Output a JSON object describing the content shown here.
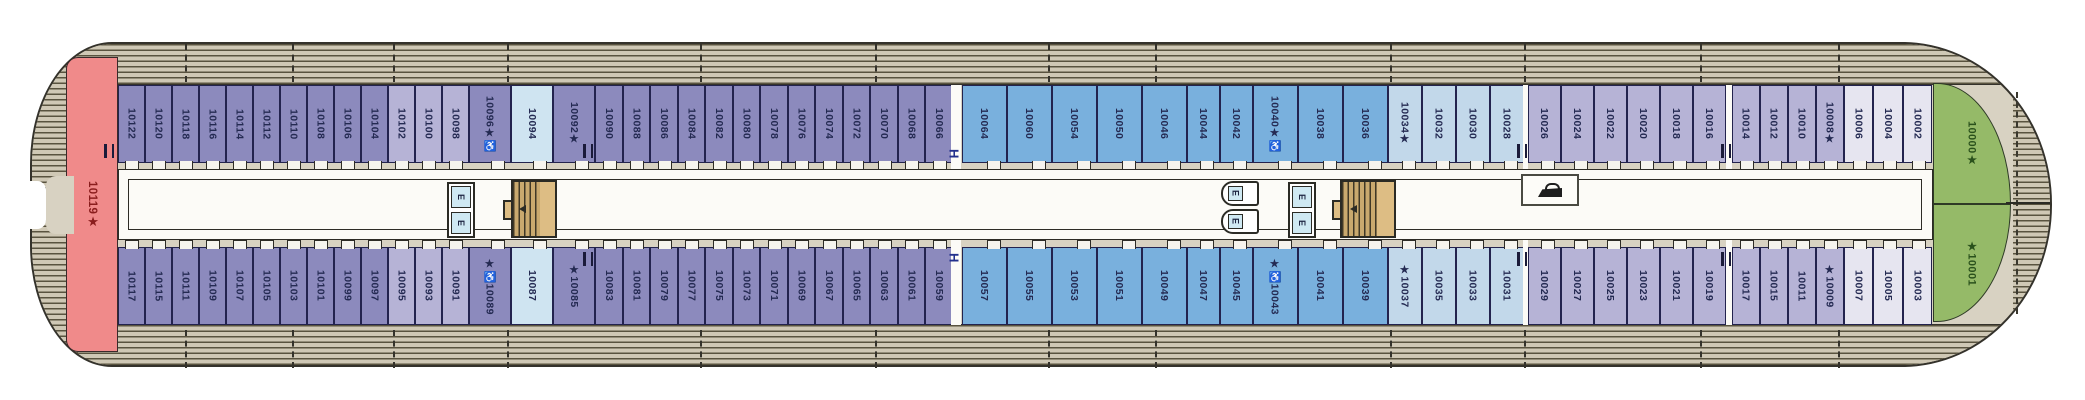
{
  "deck": {
    "layout": {
      "row_start_x": 118
    },
    "labels": {
      "elevator": "E",
      "crossing": "H"
    },
    "symbols": {
      "accessible_suite": "★♿",
      "suite": "★"
    },
    "colors": {
      "purple": "#8c8abd",
      "lavender": "#b6b3d6",
      "paleblue": "#cfe4f1",
      "blue": "#79b0dd",
      "bluelight": "#c2d8ea",
      "whitelav": "#e6e5f0",
      "red": "#f08a8a",
      "green": "#95ba68",
      "hull": "#d8d2c2",
      "corridor": "#fcfbf7"
    },
    "specials": {
      "stern": {
        "n": "10119",
        "sym": "★",
        "side": "suffix"
      },
      "bow_top": {
        "n": "10000",
        "sym": "★",
        "side": "suffix"
      },
      "bow_bottom": {
        "n": "10001",
        "sym": "★",
        "side": "prefix"
      }
    },
    "rows": {
      "top": [
        {
          "n": "10122",
          "c": "purple",
          "w": 27
        },
        {
          "n": "10120",
          "c": "purple",
          "w": 27
        },
        {
          "n": "10118",
          "c": "purple",
          "w": 27
        },
        {
          "n": "10116",
          "c": "purple",
          "w": 27
        },
        {
          "n": "10114",
          "c": "purple",
          "w": 27
        },
        {
          "n": "10112",
          "c": "purple",
          "w": 27
        },
        {
          "n": "10110",
          "c": "purple",
          "w": 27
        },
        {
          "n": "10108",
          "c": "purple",
          "w": 27
        },
        {
          "n": "10106",
          "c": "purple",
          "w": 27
        },
        {
          "n": "10104",
          "c": "purple",
          "w": 27
        },
        {
          "n": "10102",
          "c": "lavender",
          "w": 27
        },
        {
          "n": "10100",
          "c": "lavender",
          "w": 27
        },
        {
          "n": "10098",
          "c": "lavender",
          "w": 27
        },
        {
          "n": "10096",
          "c": "purple",
          "w": 42,
          "sym": "★♿"
        },
        {
          "n": "10094",
          "c": "paleblue",
          "w": 42
        },
        {
          "n": "10092",
          "c": "purple",
          "w": 42,
          "sym": "★"
        },
        {
          "n": "10090",
          "c": "purple",
          "w": 27.5
        },
        {
          "n": "10088",
          "c": "purple",
          "w": 27.5
        },
        {
          "n": "10086",
          "c": "purple",
          "w": 27.5
        },
        {
          "n": "10084",
          "c": "purple",
          "w": 27.5
        },
        {
          "n": "10082",
          "c": "purple",
          "w": 27.5
        },
        {
          "n": "10080",
          "c": "purple",
          "w": 27.5
        },
        {
          "n": "10078",
          "c": "purple",
          "w": 27.5
        },
        {
          "n": "10076",
          "c": "purple",
          "w": 27.5
        },
        {
          "n": "10074",
          "c": "purple",
          "w": 27.5
        },
        {
          "n": "10072",
          "c": "purple",
          "w": 27.5
        },
        {
          "n": "10070",
          "c": "purple",
          "w": 27.5
        },
        {
          "n": "10068",
          "c": "purple",
          "w": 27.5
        },
        {
          "n": "10066",
          "c": "purple",
          "w": 27.5
        },
        {
          "n": "10064",
          "c": "blue",
          "w": 45,
          "g": 9
        },
        {
          "n": "10060",
          "c": "blue",
          "w": 45
        },
        {
          "n": "10054",
          "c": "blue",
          "w": 45
        },
        {
          "n": "10050",
          "c": "blue",
          "w": 45
        },
        {
          "n": "10046",
          "c": "blue",
          "w": 45
        },
        {
          "n": "10044",
          "c": "blue",
          "w": 33
        },
        {
          "n": "10042",
          "c": "blue",
          "w": 33
        },
        {
          "n": "10040",
          "c": "blue",
          "w": 45,
          "sym": "★♿"
        },
        {
          "n": "10038",
          "c": "blue",
          "w": 45
        },
        {
          "n": "10036",
          "c": "blue",
          "w": 45
        },
        {
          "n": "10034",
          "c": "bluelight",
          "w": 34,
          "sym": "★"
        },
        {
          "n": "10032",
          "c": "bluelight",
          "w": 34
        },
        {
          "n": "10030",
          "c": "bluelight",
          "w": 34
        },
        {
          "n": "10028",
          "c": "bluelight",
          "w": 34
        },
        {
          "n": "10026",
          "c": "lavender",
          "w": 33,
          "g": 4
        },
        {
          "n": "10024",
          "c": "lavender",
          "w": 33
        },
        {
          "n": "10022",
          "c": "lavender",
          "w": 33
        },
        {
          "n": "10020",
          "c": "lavender",
          "w": 33
        },
        {
          "n": "10018",
          "c": "lavender",
          "w": 33
        },
        {
          "n": "10016",
          "c": "lavender",
          "w": 33
        },
        {
          "n": "10014",
          "c": "lavender",
          "w": 28,
          "g": 6
        },
        {
          "n": "10012",
          "c": "lavender",
          "w": 28
        },
        {
          "n": "10010",
          "c": "lavender",
          "w": 28
        },
        {
          "n": "10008",
          "c": "lavender",
          "w": 28,
          "sym": "★"
        },
        {
          "n": "10006",
          "c": "whitelav",
          "w": 29.5
        },
        {
          "n": "10004",
          "c": "whitelav",
          "w": 29.5
        },
        {
          "n": "10002",
          "c": "whitelav",
          "w": 29.5
        }
      ],
      "bottom": [
        {
          "n": "10117",
          "c": "purple",
          "w": 27
        },
        {
          "n": "10115",
          "c": "purple",
          "w": 27
        },
        {
          "n": "10111",
          "c": "purple",
          "w": 27
        },
        {
          "n": "10109",
          "c": "purple",
          "w": 27
        },
        {
          "n": "10107",
          "c": "purple",
          "w": 27
        },
        {
          "n": "10105",
          "c": "purple",
          "w": 27
        },
        {
          "n": "10103",
          "c": "purple",
          "w": 27
        },
        {
          "n": "10101",
          "c": "purple",
          "w": 27
        },
        {
          "n": "10099",
          "c": "purple",
          "w": 27
        },
        {
          "n": "10097",
          "c": "purple",
          "w": 27
        },
        {
          "n": "10095",
          "c": "lavender",
          "w": 27
        },
        {
          "n": "10093",
          "c": "lavender",
          "w": 27
        },
        {
          "n": "10091",
          "c": "lavender",
          "w": 27
        },
        {
          "n": "10089",
          "c": "purple",
          "w": 42,
          "sym": "★♿"
        },
        {
          "n": "10087",
          "c": "paleblue",
          "w": 42
        },
        {
          "n": "10085",
          "c": "purple",
          "w": 42,
          "sym": "★"
        },
        {
          "n": "10083",
          "c": "purple",
          "w": 27.5
        },
        {
          "n": "10081",
          "c": "purple",
          "w": 27.5
        },
        {
          "n": "10079",
          "c": "purple",
          "w": 27.5
        },
        {
          "n": "10077",
          "c": "purple",
          "w": 27.5
        },
        {
          "n": "10075",
          "c": "purple",
          "w": 27.5
        },
        {
          "n": "10073",
          "c": "purple",
          "w": 27.5
        },
        {
          "n": "10071",
          "c": "purple",
          "w": 27.5
        },
        {
          "n": "10069",
          "c": "purple",
          "w": 27.5
        },
        {
          "n": "10067",
          "c": "purple",
          "w": 27.5
        },
        {
          "n": "10065",
          "c": "purple",
          "w": 27.5
        },
        {
          "n": "10063",
          "c": "purple",
          "w": 27.5
        },
        {
          "n": "10061",
          "c": "purple",
          "w": 27.5
        },
        {
          "n": "10059",
          "c": "purple",
          "w": 27.5
        },
        {
          "n": "10057",
          "c": "blue",
          "w": 45,
          "g": 9
        },
        {
          "n": "10055",
          "c": "blue",
          "w": 45
        },
        {
          "n": "10053",
          "c": "blue",
          "w": 45
        },
        {
          "n": "10051",
          "c": "blue",
          "w": 45
        },
        {
          "n": "10049",
          "c": "blue",
          "w": 45
        },
        {
          "n": "10047",
          "c": "blue",
          "w": 33
        },
        {
          "n": "10045",
          "c": "blue",
          "w": 33
        },
        {
          "n": "10043",
          "c": "blue",
          "w": 45,
          "sym": "★♿"
        },
        {
          "n": "10041",
          "c": "blue",
          "w": 45
        },
        {
          "n": "10039",
          "c": "blue",
          "w": 45
        },
        {
          "n": "10037",
          "c": "bluelight",
          "w": 34,
          "sym": "★"
        },
        {
          "n": "10035",
          "c": "bluelight",
          "w": 34
        },
        {
          "n": "10033",
          "c": "bluelight",
          "w": 34
        },
        {
          "n": "10031",
          "c": "bluelight",
          "w": 34
        },
        {
          "n": "10029",
          "c": "lavender",
          "w": 33,
          "g": 4
        },
        {
          "n": "10027",
          "c": "lavender",
          "w": 33
        },
        {
          "n": "10025",
          "c": "lavender",
          "w": 33
        },
        {
          "n": "10023",
          "c": "lavender",
          "w": 33
        },
        {
          "n": "10021",
          "c": "lavender",
          "w": 33
        },
        {
          "n": "10019",
          "c": "lavender",
          "w": 33
        },
        {
          "n": "10017",
          "c": "lavender",
          "w": 28,
          "g": 6
        },
        {
          "n": "10015",
          "c": "lavender",
          "w": 28
        },
        {
          "n": "10011",
          "c": "lavender",
          "w": 28
        },
        {
          "n": "10009",
          "c": "lavender",
          "w": 28,
          "sym": "★"
        },
        {
          "n": "10007",
          "c": "whitelav",
          "w": 29.5
        },
        {
          "n": "10005",
          "c": "whitelav",
          "w": 29.5
        },
        {
          "n": "10003",
          "c": "whitelav",
          "w": 29.5
        }
      ]
    }
  }
}
